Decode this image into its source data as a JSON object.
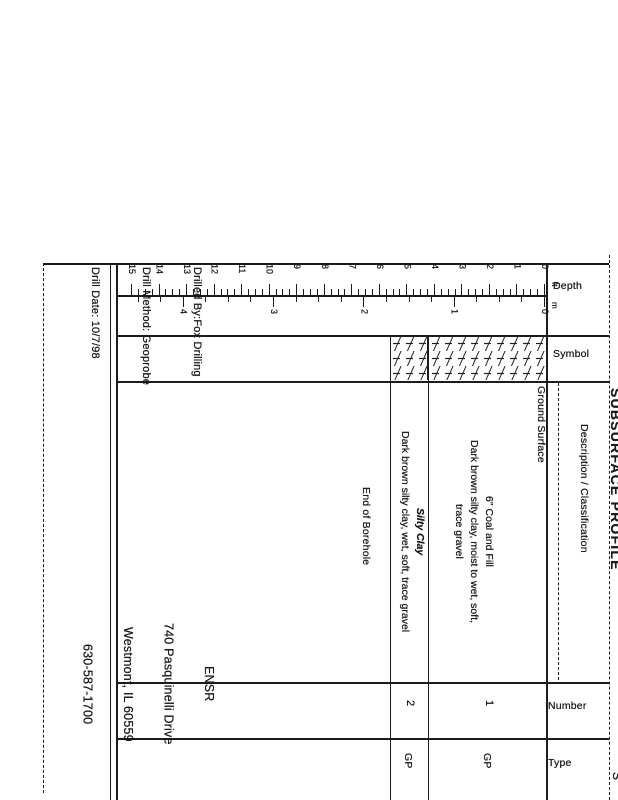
{
  "title": "SUBSURFACE PROFILE",
  "corner_fragment": "S",
  "drill_info": {
    "drilled_by": "Drilled By:Fox Drilling",
    "drill_method": "Drill Method: Geoprobe",
    "drill_date": "Drill Date: 10/7/98"
  },
  "company": {
    "name": "ENSR",
    "address1": "740 Pasquinelli Drive",
    "address2": "Westmont, IL 60559",
    "phone": "630-587-1700"
  },
  "headers": {
    "depth": "Depth",
    "symbol": "Symbol",
    "description": "Description / Classification",
    "number": "Number",
    "type": "Type"
  },
  "scale": {
    "feet": {
      "min": 0,
      "max": 15
    },
    "meters": {
      "min": 0,
      "max": 4
    },
    "unit_feet": "ft",
    "unit_meters": "m"
  },
  "annotations": {
    "ground_surface": "Ground Surface",
    "end_of_borehole": "End of Borehole"
  },
  "layers": [
    {
      "title": "6\" Coal and Fill",
      "desc_line1": "Dark brown silty clay, moist to wet, soft,",
      "desc_line2": "trace gravel",
      "depth_from_ft": 0,
      "depth_to_ft": 4.2,
      "number": "1",
      "type": "GP"
    },
    {
      "title": "Silty Clay",
      "desc_line1": "Dark brown silty clay, wet, soft, trace gravel",
      "desc_line2": "",
      "depth_from_ft": 4.2,
      "depth_to_ft": 5.6,
      "number": "2",
      "type": "GP"
    }
  ]
}
